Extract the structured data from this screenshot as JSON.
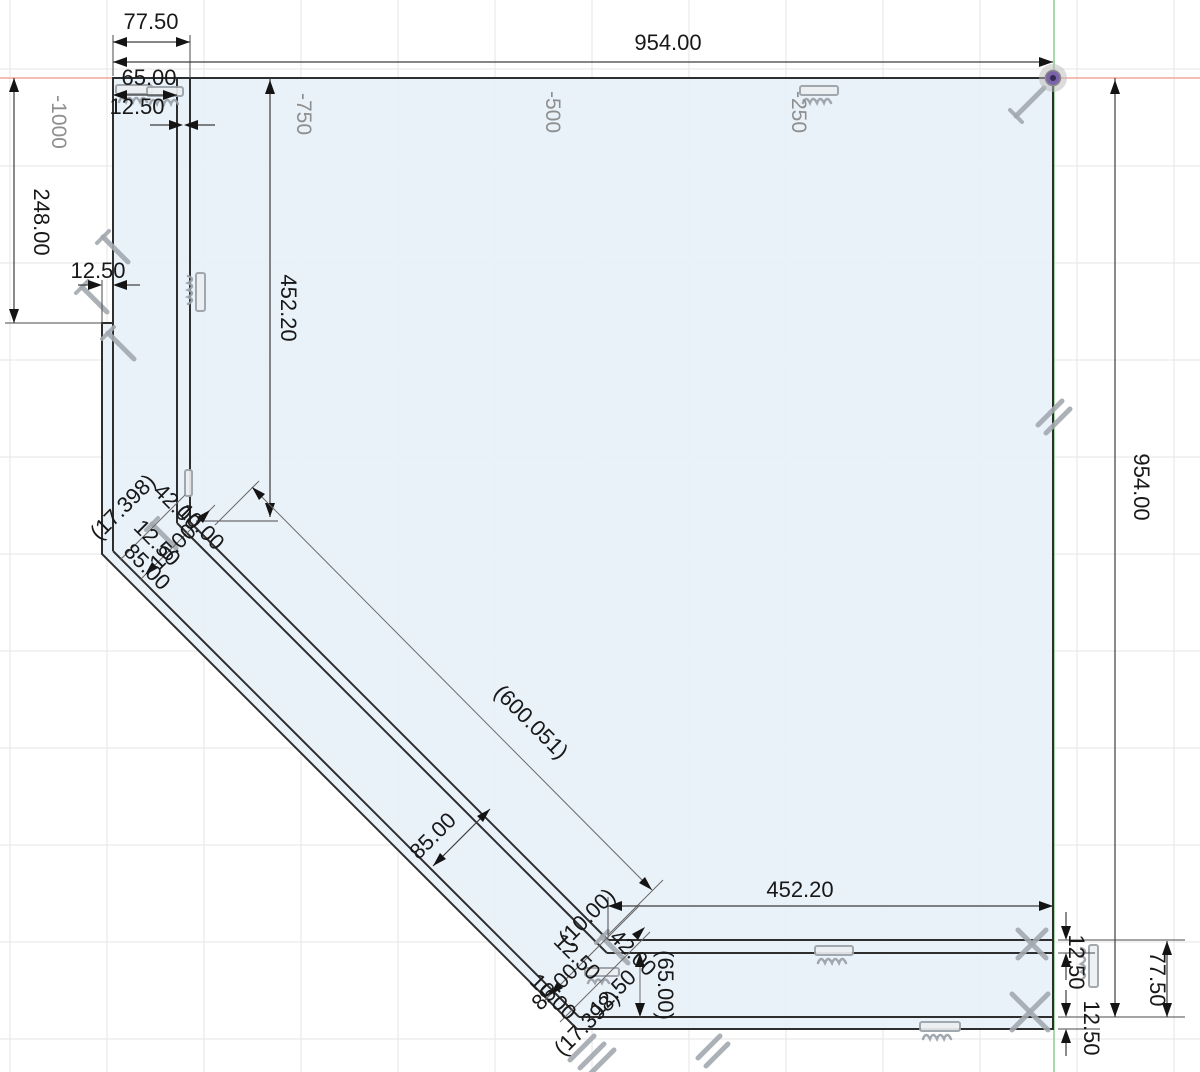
{
  "app": {
    "canvas_kind": "cad-sketch-canvas"
  },
  "colors": {
    "sketch_fill": "#e7f0f8",
    "geometry_line": "#2e2e2e",
    "x_axis_red": "#f2a79c",
    "y_axis_green": "#93d093",
    "dimension_text": "#181818",
    "grid_label_gray": "#8e8e8e",
    "constraint_icon_gray": "#9aa1a8",
    "origin_purple": "#7a63ab"
  },
  "grid_labels": {
    "x1": "-1000",
    "x2": "-750",
    "x3": "-500",
    "x4": "-250"
  },
  "dimensions": {
    "top": {
      "flange": "77.50",
      "overall": "954.00",
      "member": "65.00",
      "inner_flange": "12.50"
    },
    "left": {
      "offset": "248.00",
      "step": "12.50",
      "span": "452.20"
    },
    "right": {
      "overall": "954.00"
    },
    "diagonal": {
      "ref_length": "(600.051)",
      "band_width": "85.00"
    },
    "bottom": {
      "span": "452.20",
      "flange_top": "12.50",
      "member": "77.50",
      "flange_bottom": "12.50",
      "member_ref": "(65.00)"
    }
  },
  "cluster_top": [
    "42.00",
    "(17.398)",
    "12.50",
    "10.00",
    "85.00",
    "10.00"
  ],
  "cluster_bottom": [
    "(10.00)",
    "42.00",
    "12.50",
    "85.00",
    "(17.398)",
    "10.00",
    "12.50"
  ],
  "icons": {
    "ground_constraint": "hatched-bar",
    "pin_constraint": "diagonal-pin",
    "parallel_constraint": "double-slash",
    "perpendicular_constraint": "cross",
    "origin_marker": "purple-dot"
  }
}
